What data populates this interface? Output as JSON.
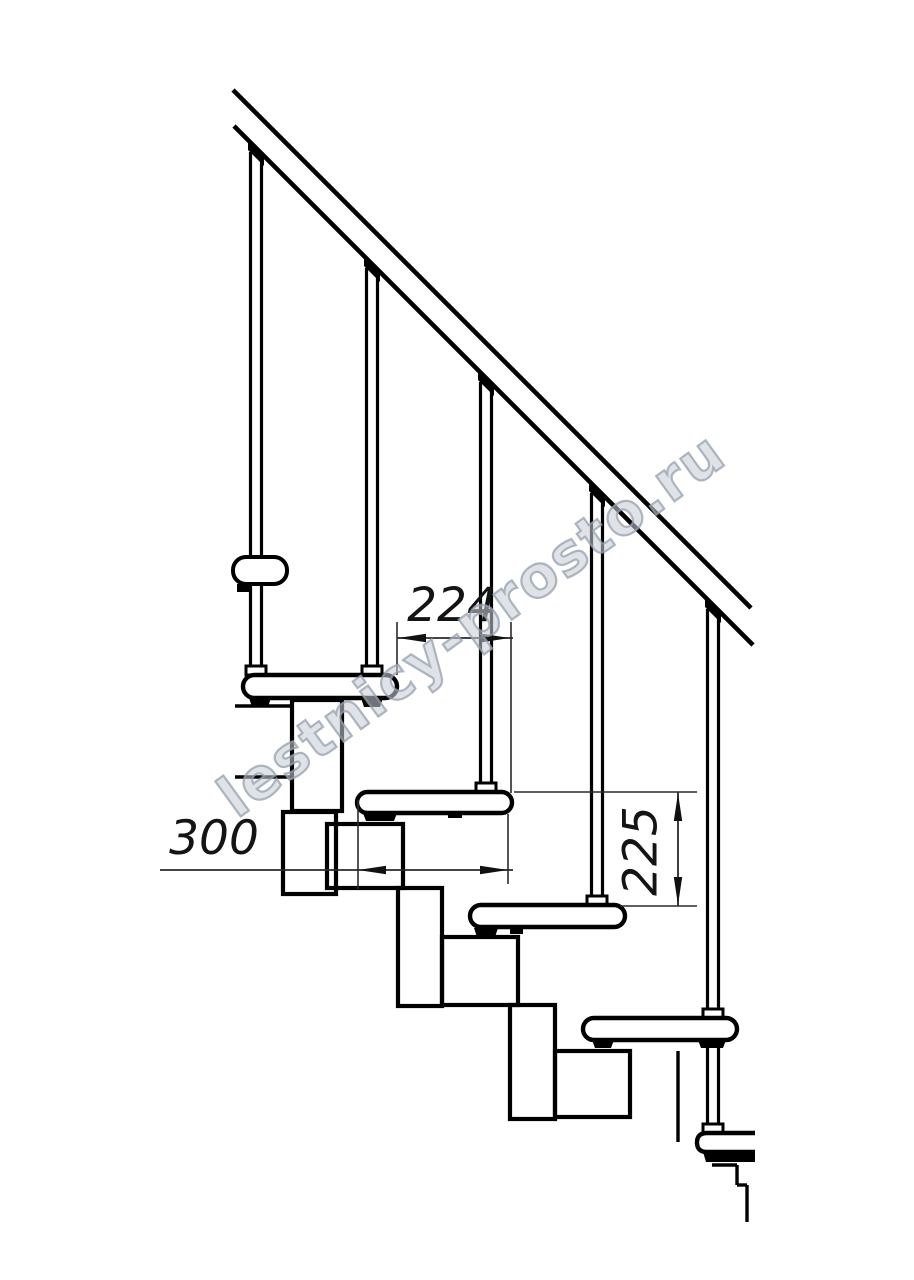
{
  "drawing": {
    "title_semantic": "modular staircase side elevation",
    "background_color": "#ffffff",
    "line_color": "#000000",
    "dim_line_color": "#2a2a2a",
    "dimensions": {
      "run": {
        "label": "224"
      },
      "tread_depth": {
        "label": "300"
      },
      "rise": {
        "label": "225"
      }
    },
    "watermark": {
      "text": "lestnicy-prosto.ru",
      "color": "#94a0ad"
    }
  }
}
